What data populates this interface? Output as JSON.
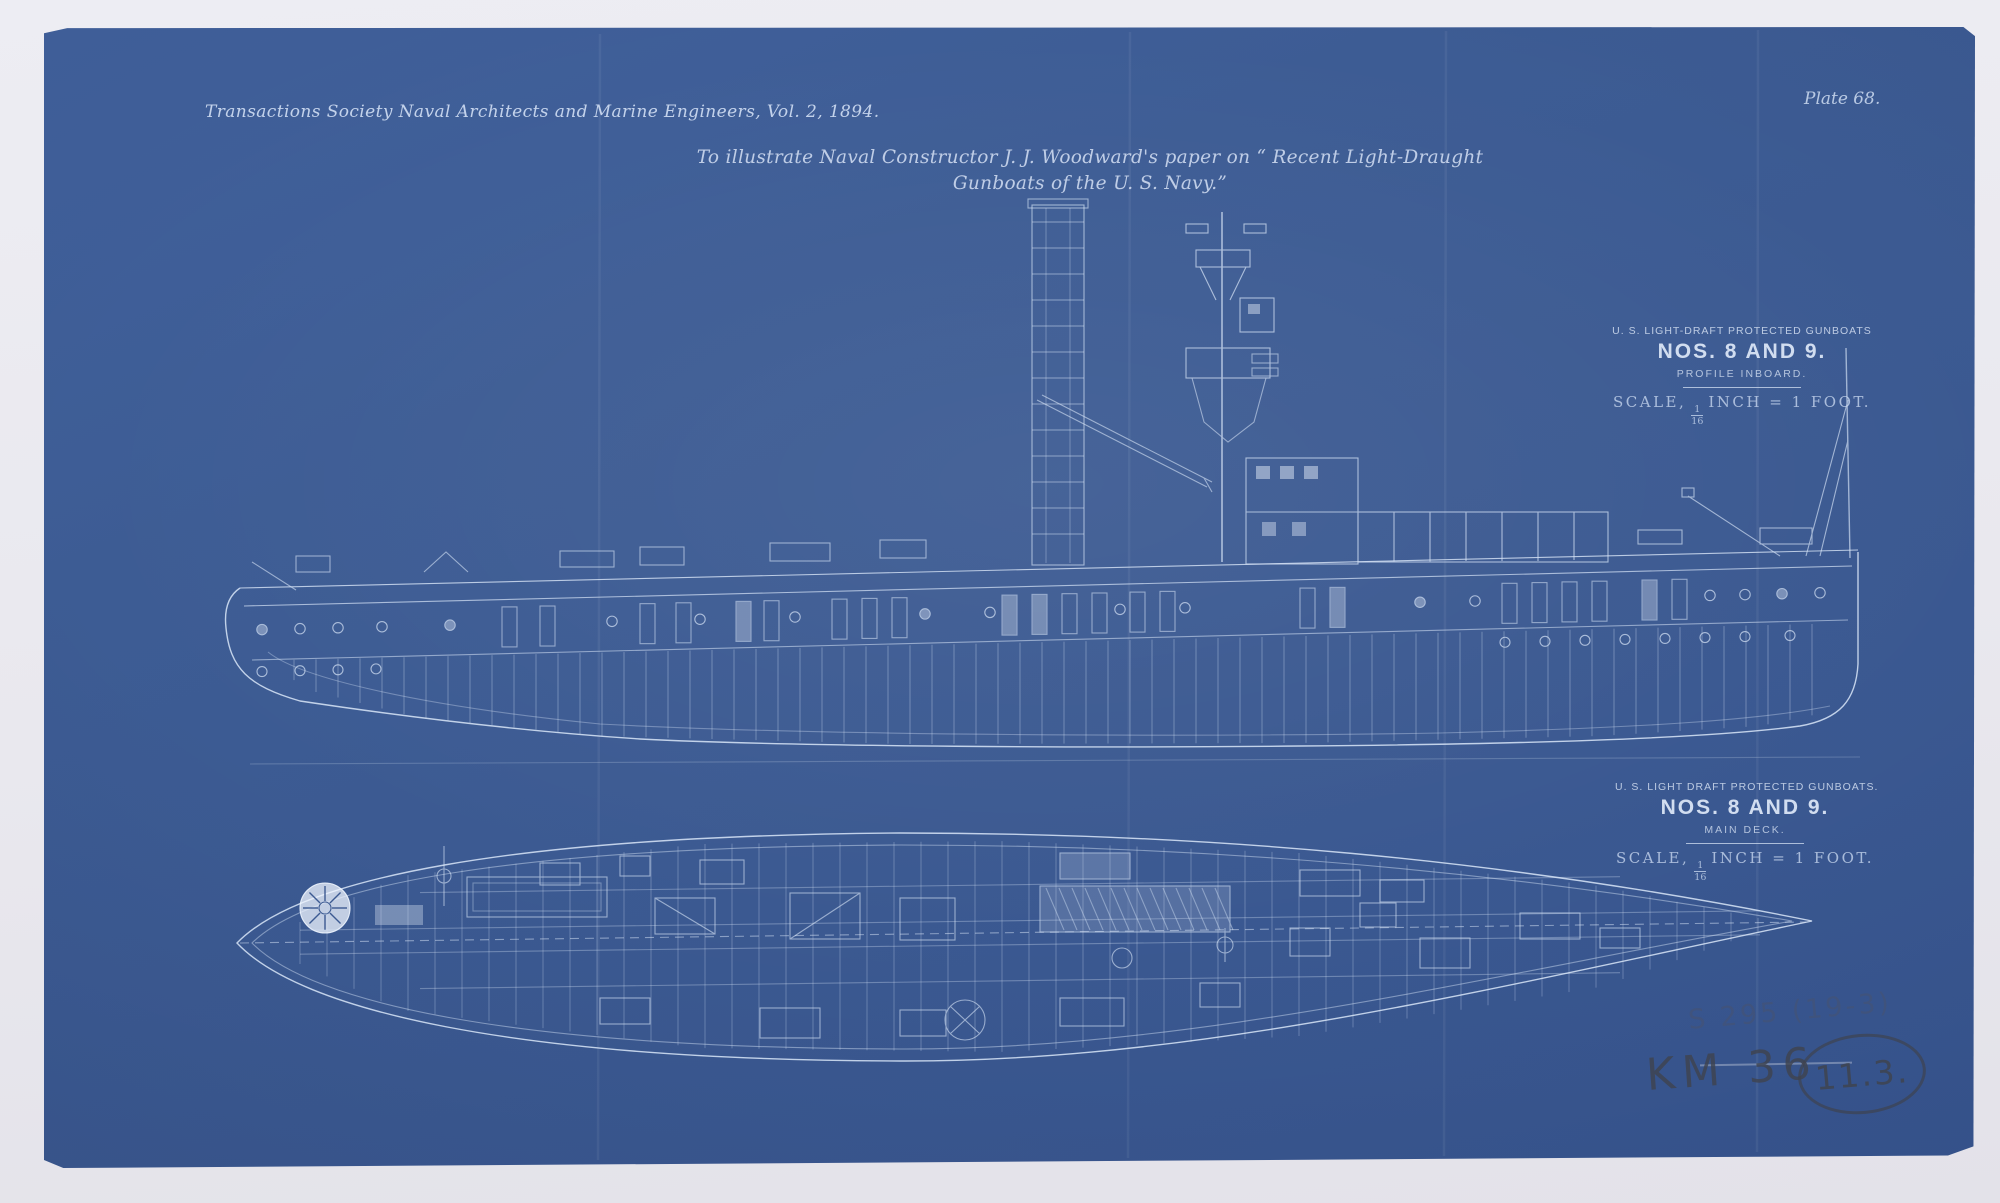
{
  "colors": {
    "paper": "#e9e8ee",
    "blueprint": "#3c5a92",
    "line_ink": "#d9e6f8",
    "pencil": "#3f4450"
  },
  "page": {
    "journal_line": "Transactions Society Naval Architects and Marine Engineers, Vol. 2, 1894.",
    "plate_label": "Plate 68.",
    "caption_line1": "To illustrate Naval Constructor J. J. Woodward's paper on “ Recent Light-Draught",
    "caption_line2": "Gunboats of the U. S. Navy.”"
  },
  "profile_block": {
    "line1": "U. S. LIGHT-DRAFT PROTECTED GUNBOATS",
    "line2": "NOS. 8 AND 9.",
    "line3": "PROFILE INBOARD.",
    "scale_prefix": "SCALE,",
    "scale_num": "1",
    "scale_den": "16",
    "scale_suffix": "INCH = 1 FOOT."
  },
  "deck_block": {
    "line1": "U. S. LIGHT DRAFT PROTECTED GUNBOATS.",
    "line2": "NOS. 8 AND 9.",
    "line3": "MAIN DECK.",
    "scale_prefix": "SCALE,",
    "scale_num": "1",
    "scale_den": "16",
    "scale_suffix": "INCH = 1 FOOT."
  },
  "annotations": {
    "pencil_code": "KM 36",
    "pencil_circled": "11.3.",
    "pencil_faint": "S 295 (19-3)"
  }
}
